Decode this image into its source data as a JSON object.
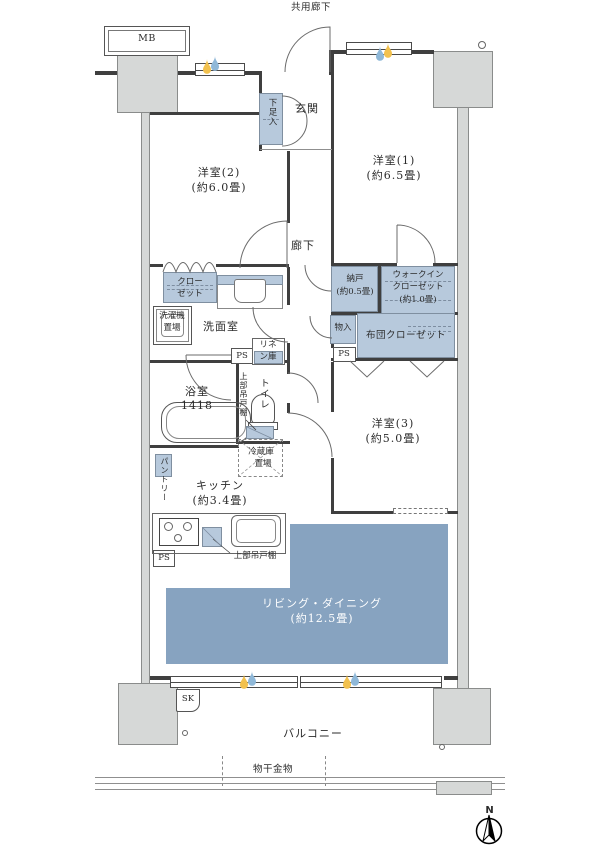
{
  "page": {
    "corridor_label": "共用廊下",
    "mb": "MB",
    "compass_n": "N"
  },
  "rooms": {
    "genkan": {
      "name": "玄関"
    },
    "yoshitsu1": {
      "name": "洋室(1)",
      "size": "(約6.5畳)"
    },
    "yoshitsu2": {
      "name": "洋室(2)",
      "size": "(約6.0畳)"
    },
    "yoshitsu3": {
      "name": "洋室(3)",
      "size": "(約5.0畳)"
    },
    "rouka": {
      "name": "廊下"
    },
    "senmenshitsu": {
      "name": "洗面室"
    },
    "yokushitsu": {
      "name": "浴室",
      "size": "1418"
    },
    "toilet": {
      "name": "トイレ"
    },
    "kitchen": {
      "name": "キッチン",
      "size": "(約3.4畳)"
    },
    "living": {
      "name": "リビング・ダイニング",
      "size": "(約12.5畳)"
    },
    "balcony": {
      "name": "バルコニー"
    }
  },
  "storage": {
    "getabako": "下足入",
    "closet": {
      "line1": "クロー",
      "line2": "ゼット"
    },
    "nando": {
      "name": "納戸",
      "size": "(約0.5畳)"
    },
    "wic": {
      "line1": "ウォークイン",
      "line2": "クローゼット",
      "size": "(約1.0畳)"
    },
    "monoire": "物入",
    "futon_closet": "布団クローゼット",
    "linen": {
      "line1": "リネ",
      "line2": "ン庫"
    },
    "pantry": "パントリー",
    "tsuridana": "上部吊戸棚"
  },
  "fixtures": {
    "ps": "PS",
    "sk": "SK",
    "washer": {
      "line1": "洗濯機",
      "line2": "置場"
    },
    "fridge": {
      "line1": "冷蔵庫",
      "line2": "置場"
    },
    "monohoshi": "物干金物"
  },
  "colors": {
    "storage_blue": "#b7c9dc",
    "living_blue": "#87a3c0",
    "pillar_gray": "#d6d8d7"
  }
}
